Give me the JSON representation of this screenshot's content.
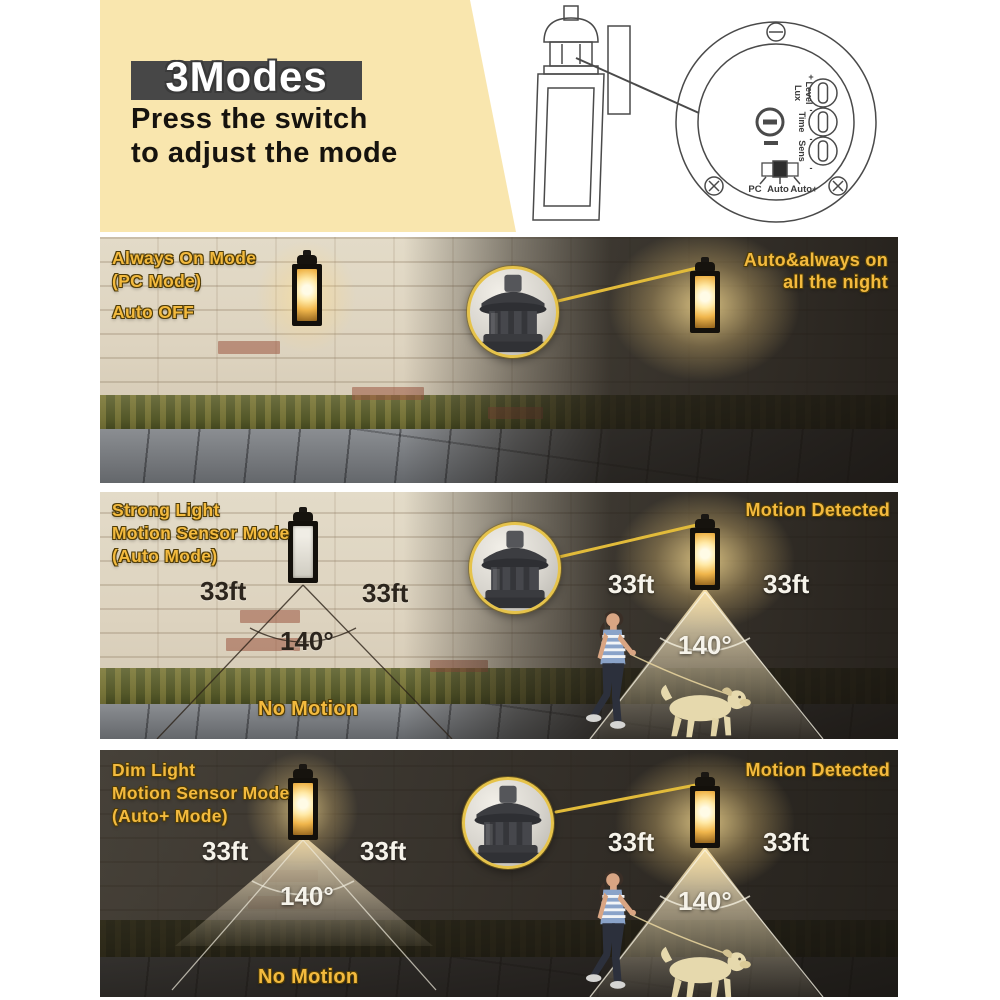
{
  "header": {
    "badge": "3Modes",
    "line1": "Press the switch",
    "line2": "to adjust the mode"
  },
  "diagram": {
    "knob1_line1": "Lux",
    "knob1_line2": "Level",
    "knob2": "Time",
    "knob3": "Sens",
    "plus": "+",
    "minus": "-",
    "switch_options": [
      "PC",
      "Auto",
      "Auto+"
    ]
  },
  "panels": [
    {
      "title1": "Always On Mode",
      "title2": "(PC Mode)",
      "status": "Auto OFF",
      "caption1": "Auto&always on",
      "caption2": "all the night"
    },
    {
      "title1": "Strong Light",
      "title2": "Motion Sensor Mode",
      "title3": "(Auto Mode)",
      "day_dist_left": "33ft",
      "day_dist_right": "33ft",
      "day_angle": "140°",
      "day_status": "No Motion",
      "night_caption": "Motion Detected",
      "night_dist_left": "33ft",
      "night_dist_right": "33ft",
      "night_angle": "140°"
    },
    {
      "title1": "Dim Light",
      "title2": "Motion Sensor Mode",
      "title3": "(Auto+ Mode)",
      "day_dist_left": "33ft",
      "day_dist_right": "33ft",
      "day_angle": "140°",
      "day_status": "No Motion",
      "night_caption": "Motion Detected",
      "night_dist_left": "33ft",
      "night_dist_right": "33ft",
      "night_angle": "140°"
    }
  ],
  "sensor_specs": {
    "range": "33ft",
    "angle": "140°"
  },
  "colors": {
    "accent_yellow": "#f3ba3e",
    "cream_bg": "#f9e6ae",
    "badge_bg": "#474747",
    "day_wall": "#e3dbc8",
    "night_overlay": "#1a1611",
    "ring_yellow": "#e6c34a",
    "white_label": "#f6f3ea"
  }
}
